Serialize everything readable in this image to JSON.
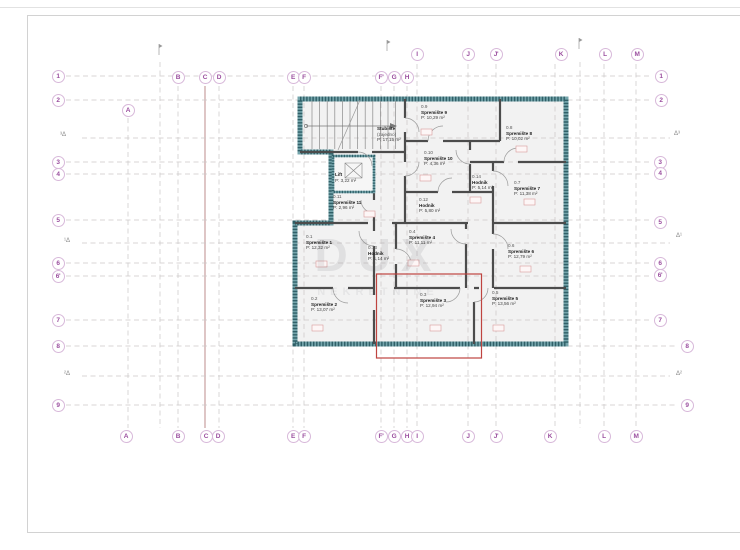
{
  "drawing": {
    "type": "floor-plan",
    "language": "Croatian",
    "highlight_color": "#bf4440"
  },
  "grid": {
    "letters_top": [
      {
        "label": "A",
        "x": 128,
        "y": 110
      },
      {
        "label": "B",
        "x": 178,
        "y": 77
      },
      {
        "label": "C",
        "x": 205,
        "y": 77
      },
      {
        "label": "D",
        "x": 219,
        "y": 77
      },
      {
        "label": "E",
        "x": 293,
        "y": 77
      },
      {
        "label": "F",
        "x": 304,
        "y": 77
      },
      {
        "label": "F'",
        "x": 381,
        "y": 77
      },
      {
        "label": "G",
        "x": 394,
        "y": 77
      },
      {
        "label": "H",
        "x": 407,
        "y": 77
      },
      {
        "label": "I",
        "x": 417,
        "y": 54
      },
      {
        "label": "J",
        "x": 468,
        "y": 54
      },
      {
        "label": "J'",
        "x": 496,
        "y": 54
      },
      {
        "label": "K",
        "x": 561,
        "y": 54
      },
      {
        "label": "L",
        "x": 605,
        "y": 54
      },
      {
        "label": "M",
        "x": 637,
        "y": 54
      }
    ],
    "letters_bottom": [
      {
        "label": "A",
        "x": 126,
        "y": 436
      },
      {
        "label": "B",
        "x": 178,
        "y": 436
      },
      {
        "label": "C",
        "x": 206,
        "y": 436
      },
      {
        "label": "D",
        "x": 218,
        "y": 436
      },
      {
        "label": "E",
        "x": 293,
        "y": 436
      },
      {
        "label": "F",
        "x": 304,
        "y": 436
      },
      {
        "label": "F'",
        "x": 381,
        "y": 436
      },
      {
        "label": "G",
        "x": 394,
        "y": 436
      },
      {
        "label": "H",
        "x": 407,
        "y": 436
      },
      {
        "label": "I",
        "x": 417,
        "y": 436
      },
      {
        "label": "J",
        "x": 468,
        "y": 436
      },
      {
        "label": "J'",
        "x": 496,
        "y": 436
      },
      {
        "label": "K",
        "x": 550,
        "y": 436
      },
      {
        "label": "L",
        "x": 604,
        "y": 436
      },
      {
        "label": "M",
        "x": 636,
        "y": 436
      }
    ],
    "numbers_left": [
      {
        "label": "1",
        "x": 58,
        "y": 76
      },
      {
        "label": "2",
        "x": 58,
        "y": 100
      },
      {
        "label": "3",
        "x": 58,
        "y": 162
      },
      {
        "label": "4",
        "x": 58,
        "y": 174
      },
      {
        "label": "5",
        "x": 58,
        "y": 220
      },
      {
        "label": "6",
        "x": 58,
        "y": 263
      },
      {
        "label": "6'",
        "x": 58,
        "y": 276
      },
      {
        "label": "7",
        "x": 58,
        "y": 320
      },
      {
        "label": "8",
        "x": 58,
        "y": 346
      },
      {
        "label": "9",
        "x": 58,
        "y": 405
      }
    ],
    "numbers_right": [
      {
        "label": "1",
        "x": 661,
        "y": 76
      },
      {
        "label": "2",
        "x": 661,
        "y": 100
      },
      {
        "label": "3",
        "x": 660,
        "y": 162
      },
      {
        "label": "4",
        "x": 660,
        "y": 173
      },
      {
        "label": "5",
        "x": 660,
        "y": 222
      },
      {
        "label": "6",
        "x": 660,
        "y": 263
      },
      {
        "label": "6'",
        "x": 660,
        "y": 275
      },
      {
        "label": "7",
        "x": 660,
        "y": 320
      },
      {
        "label": "8",
        "x": 687,
        "y": 346
      },
      {
        "label": "9",
        "x": 687,
        "y": 405
      }
    ],
    "elevation_markers": [
      {
        "label": "³Δ",
        "x": 60,
        "y": 132
      },
      {
        "label": "¹Δ",
        "x": 64,
        "y": 238
      },
      {
        "label": "²Δ",
        "x": 64,
        "y": 371
      },
      {
        "label": "Δ³",
        "x": 674,
        "y": 131
      },
      {
        "label": "Δ¹",
        "x": 676,
        "y": 233
      },
      {
        "label": "Δ²",
        "x": 676,
        "y": 371
      }
    ]
  },
  "rooms": [
    {
      "number": "",
      "name": "Stubište",
      "extra": "(zajedno)",
      "area": "P: 17,15 m²",
      "x": 377,
      "y": 126
    },
    {
      "number": "",
      "name": "Lift",
      "extra": "",
      "area": "P: 3,22 m²",
      "x": 335,
      "y": 172
    },
    {
      "number": "0.9",
      "name": "Spremište 9",
      "extra": "",
      "area": "P: 10,29 m²",
      "x": 421,
      "y": 104
    },
    {
      "number": "0.8",
      "name": "Spremište 8",
      "extra": "",
      "area": "P: 10,02 m²",
      "x": 506,
      "y": 125
    },
    {
      "number": "0.10",
      "name": "Spremište 10",
      "extra": "",
      "area": "P: 4,36 m²",
      "x": 424,
      "y": 150
    },
    {
      "number": "0.14",
      "name": "Hodnik",
      "extra": "",
      "area": "P: 5,14 m²",
      "x": 472,
      "y": 174
    },
    {
      "number": "0.7",
      "name": "Spremište 7",
      "extra": "",
      "area": "P: 11,38 m²",
      "x": 514,
      "y": 180
    },
    {
      "number": "0.11",
      "name": "Spremište 11",
      "extra": "",
      "area": "P: 2,96 m²",
      "x": 333,
      "y": 194
    },
    {
      "number": "0.12",
      "name": "Hodnik",
      "extra": "",
      "area": "P: 5,80 m²",
      "x": 419,
      "y": 197
    },
    {
      "number": "0.1",
      "name": "Spremište 1",
      "extra": "",
      "area": "P: 12,32 m²",
      "x": 306,
      "y": 234
    },
    {
      "number": "0.4",
      "name": "Spremište 4",
      "extra": "",
      "area": "P: 11,11 m²",
      "x": 409,
      "y": 229
    },
    {
      "number": "0.13",
      "name": "Hodnik",
      "extra": "",
      "area": "P: 1,14 m²",
      "x": 368,
      "y": 245
    },
    {
      "number": "0.6",
      "name": "Spremište 6",
      "extra": "",
      "area": "P: 12,79 m²",
      "x": 508,
      "y": 243
    },
    {
      "number": "0.2",
      "name": "Spremište 2",
      "extra": "",
      "area": "P: 13,07 m²",
      "x": 311,
      "y": 296
    },
    {
      "number": "0.3",
      "name": "Spremište 3",
      "extra": "",
      "area": "P: 12,94 m²",
      "x": 420,
      "y": 292
    },
    {
      "number": "0.5",
      "name": "Spremište 5",
      "extra": "",
      "area": "P: 13,56 m²",
      "x": 492,
      "y": 290
    }
  ],
  "watermark": {
    "line1": "DUX",
    "line2": "NEKRETNINE"
  }
}
